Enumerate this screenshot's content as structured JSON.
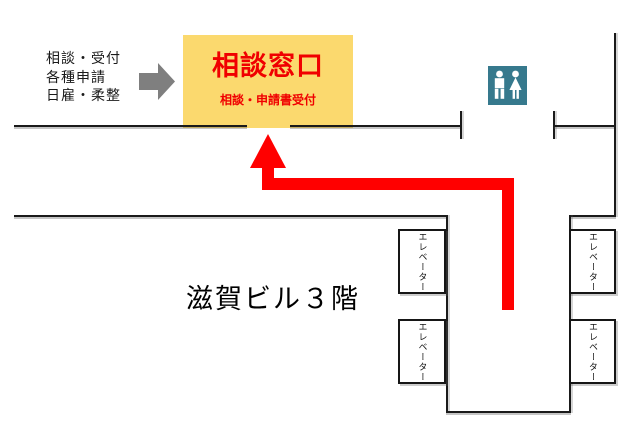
{
  "annotation": {
    "lines": [
      "相談・受付",
      "各種申請",
      "日雇・柔整"
    ]
  },
  "consultation": {
    "title": "相談窓口",
    "subtitle": "相談・申請書受付",
    "bg_color": "#FBD96E",
    "text_color": "#F00000"
  },
  "building_label": "滋賀ビル３階",
  "elevator": {
    "label": "エレベーター",
    "count": 4
  },
  "icons": {
    "restroom": "restroom-icon",
    "guide": "right-arrow-icon",
    "route": "route-up-arrow"
  },
  "colors": {
    "route_arrow": "#FF0000",
    "guide_arrow": "#7F7F7F",
    "restroom_bg": "#36798D",
    "wall": "#1A1A1A",
    "background": "#FFFFFF"
  }
}
